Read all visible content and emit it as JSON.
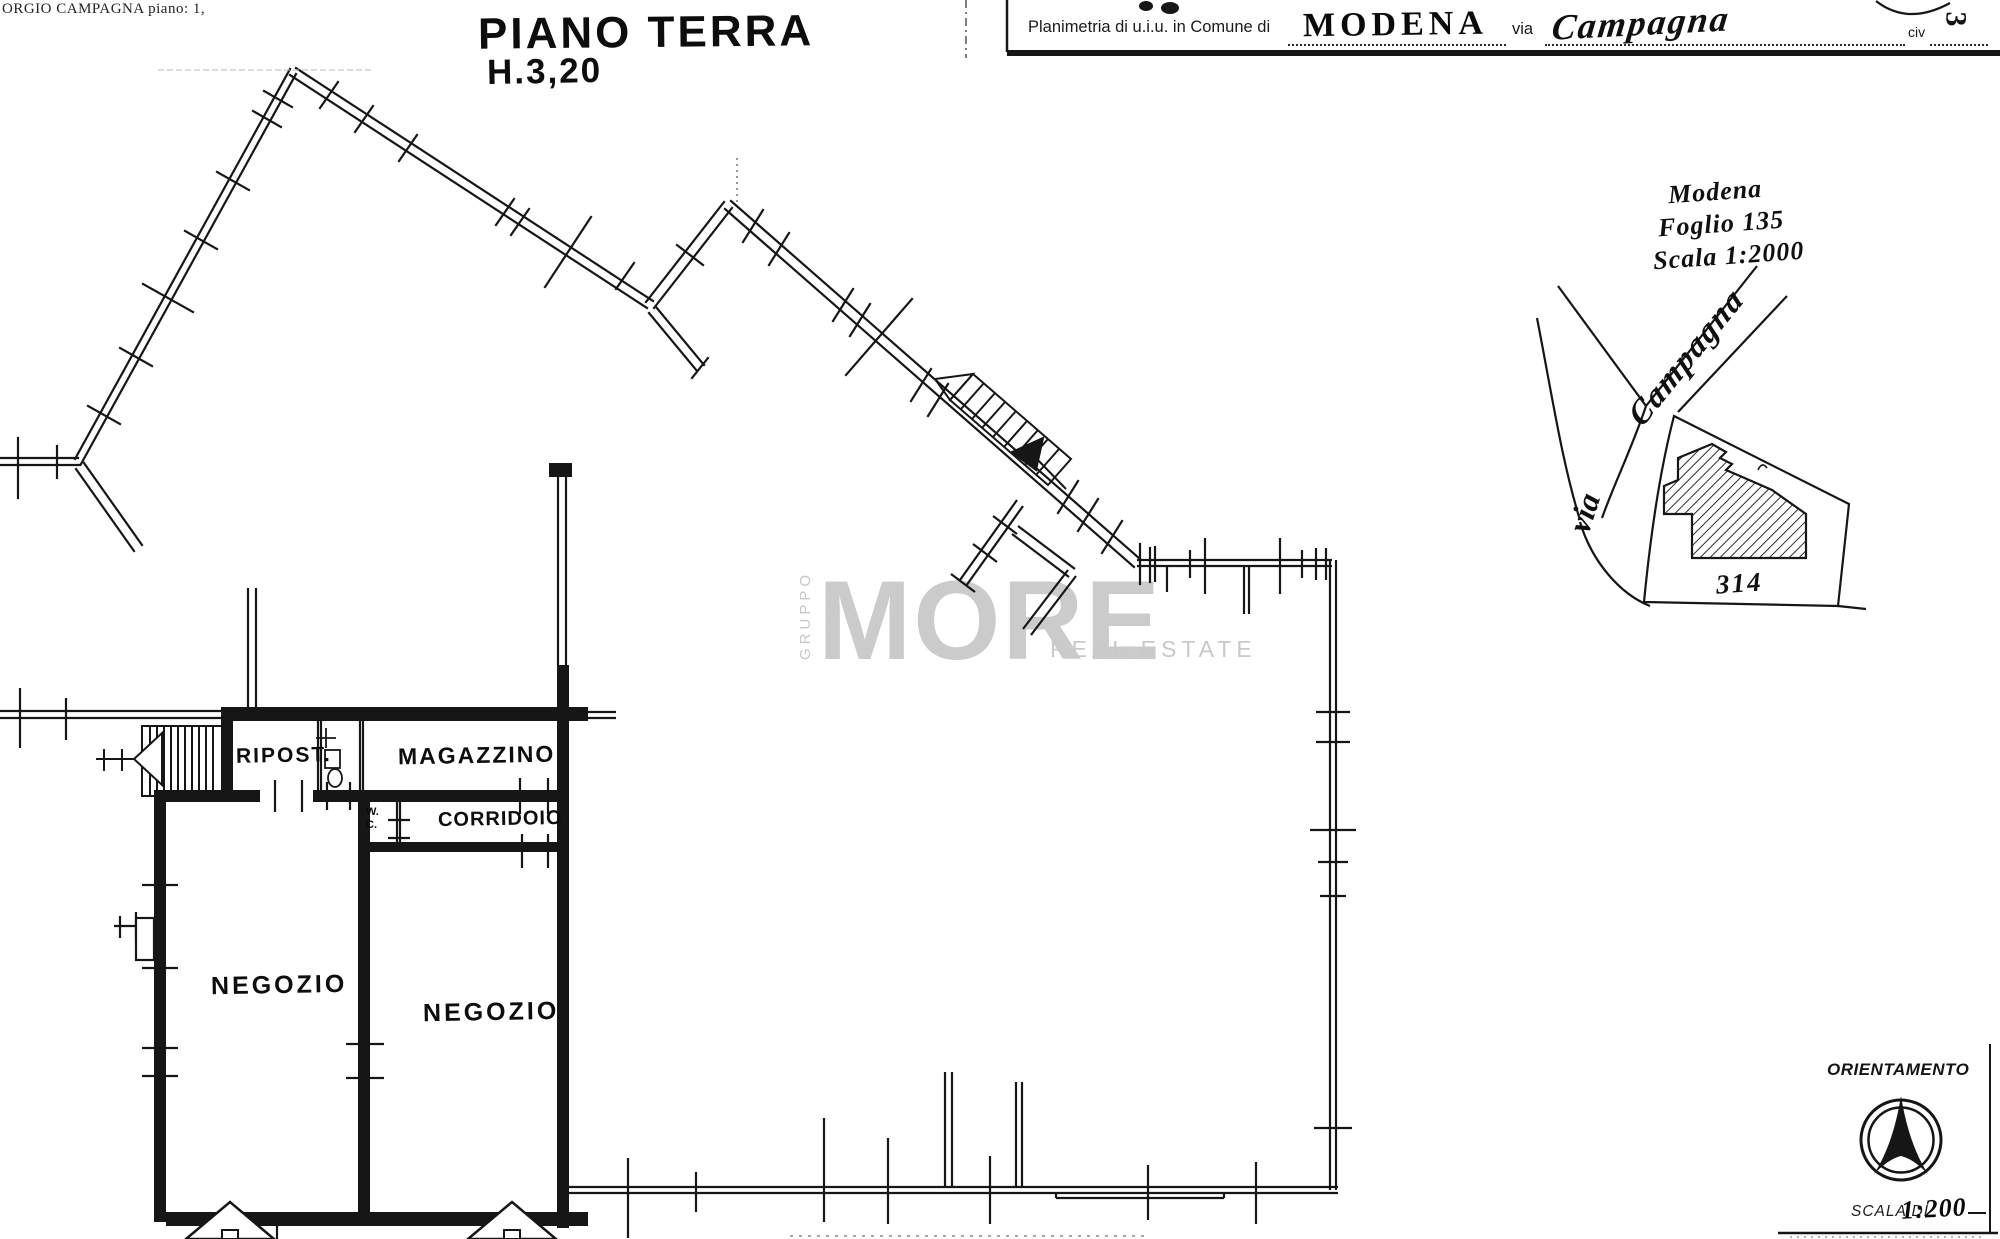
{
  "notes": {
    "top_left": "ORGIO CAMPAGNA piano: 1,"
  },
  "title_stamp": {
    "line1": "PIANO TERRA",
    "line2": "H.3,20"
  },
  "header": {
    "prefix": "Planimetria di u.i.u. in Comune di",
    "comune": "MODENA",
    "via_label": "via",
    "via_value": "Campagna",
    "civ_label": "civ",
    "page_number": "3"
  },
  "cadastre_note": {
    "city": "Modena",
    "sheet": "Foglio 135",
    "scale": "Scala 1:2000"
  },
  "map": {
    "via": "via",
    "street": "Campagna",
    "parcel": "314"
  },
  "watermark": {
    "vertical": "GRUPPO",
    "main": "MORE",
    "sub": "REAL ESTATE",
    "color": "#cbcbcb"
  },
  "rooms": {
    "ripost": "RIPOST.",
    "magazzino": "MAGAZZINO",
    "wc_line1": "W.",
    "wc_line2": "C.",
    "corridoio": "CORRIDOIO",
    "negozio_left": "NEGOZIO",
    "negozio_right": "NEGOZIO"
  },
  "orientation": {
    "label": "ORIENTAMENTO"
  },
  "scale_footer": {
    "typed": "SCALA DI",
    "handwritten": "1:200"
  },
  "colors": {
    "ink": "#161616",
    "paper": "#ffffff"
  }
}
